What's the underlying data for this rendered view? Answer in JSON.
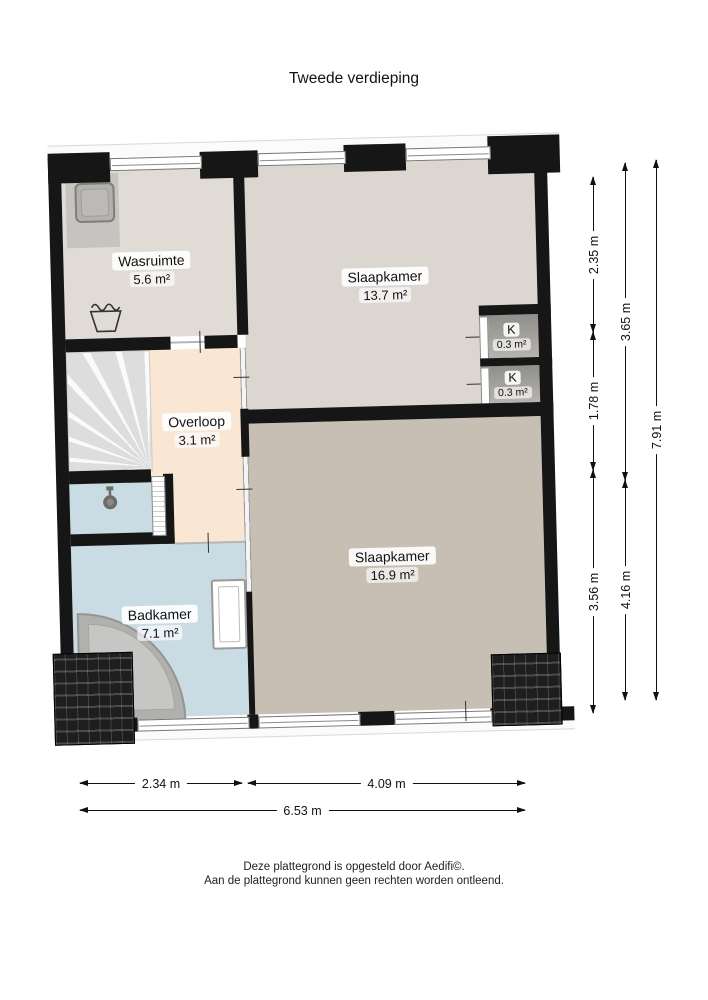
{
  "title": "Tweede verdieping",
  "rooms": [
    {
      "id": "wasruimte",
      "name": "Wasruimte",
      "area": "5.6 m²"
    },
    {
      "id": "slaapkamer-1",
      "name": "Slaapkamer",
      "area": "13.7 m²"
    },
    {
      "id": "kast-1",
      "name": "K",
      "area": "0.3 m²"
    },
    {
      "id": "kast-2",
      "name": "K",
      "area": "0.3 m²"
    },
    {
      "id": "overloop",
      "name": "Overloop",
      "area": "3.1 m²"
    },
    {
      "id": "badkamer",
      "name": "Badkamer",
      "area": "7.1 m²"
    },
    {
      "id": "slaapkamer-2",
      "name": "Slaapkamer",
      "area": "16.9 m²"
    }
  ],
  "dimensions": {
    "right": [
      {
        "label": "2.35 m"
      },
      {
        "label": "1.78 m"
      },
      {
        "label": "3.56 m"
      },
      {
        "label": "3.65 m"
      },
      {
        "label": "4.16 m"
      },
      {
        "label": "7.91 m"
      }
    ],
    "bottom": [
      {
        "label": "2.34 m"
      },
      {
        "label": "4.09 m"
      },
      {
        "label": "6.53 m"
      }
    ]
  },
  "footer": {
    "line1": "Deze plattegrond is opgesteld door Aedifi©.",
    "line2": "Aan de plattegrond kunnen geen rechten worden ontleend."
  },
  "icons": [
    "washing-machine-icon",
    "laundry-tub-icon",
    "shower-icon",
    "bathtub-icon",
    "radiator-icon",
    "roof-tiles",
    "stairs"
  ],
  "colors": {
    "wall": "#161616",
    "floor_wasruimte": "#e0dcd5",
    "floor_slaapkamer1": "#dbd7d0",
    "floor_overloop": "#f9e6d3",
    "floor_badkamer": "#c9dbe3",
    "floor_slaapkamer2": "#c8bfb4",
    "closet": "#a09d99",
    "dimension_text": "#111111"
  }
}
